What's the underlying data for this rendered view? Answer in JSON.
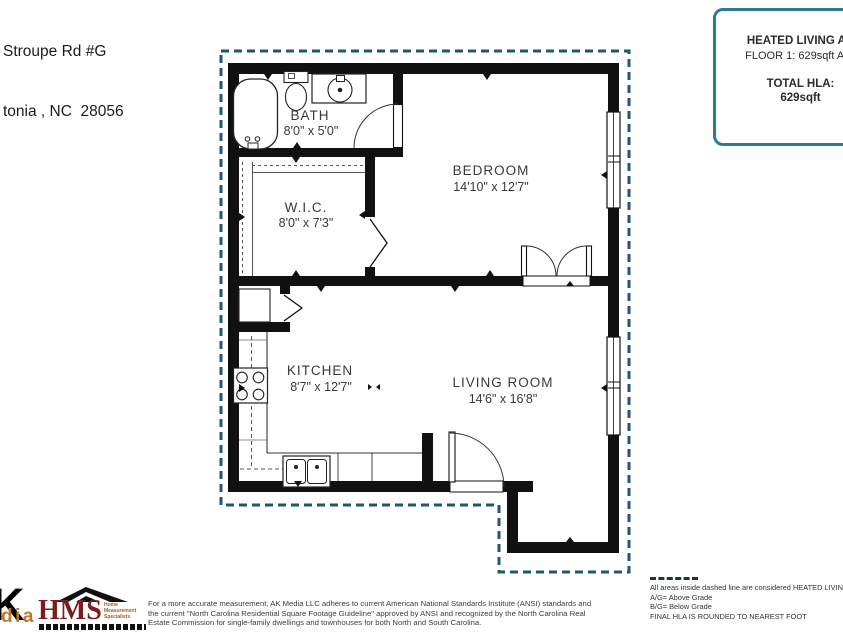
{
  "address": {
    "line1": "Stroupe Rd #G",
    "line2": "tonia , NC  28056"
  },
  "hla_box": {
    "title": "HEATED LIVING AR",
    "floor_line": "FLOOR 1: 629sqft  A/G",
    "total_label": "TOTAL HLA:",
    "total_value": "629sqft",
    "border_color": "#2a7b93"
  },
  "plan": {
    "boundary_color": "#1e586e",
    "wall_color": "#111111",
    "rooms": [
      {
        "name": "BATH",
        "dims": "8'0\" x 5'0\""
      },
      {
        "name": "BEDROOM",
        "dims": "14'10\" x 12'7\""
      },
      {
        "name": "W.I.C.",
        "dims": "8'0\" x 7'3\""
      },
      {
        "name": "KITCHEN",
        "dims": "8'7\" x 12'7\""
      },
      {
        "name": "LIVING ROOM",
        "dims": "14'6\" x 16'8\""
      }
    ]
  },
  "branding": {
    "ak_letter": "K",
    "ak_sub": "dia",
    "hms": "HMS",
    "hms_lines": [
      "Home",
      "Measurement",
      "Specialists"
    ]
  },
  "footer": {
    "disclaimer_lines": [
      "For a more accurate measurement, AK Media LLC adheres to current American National Standards Institute (ANSI) standards and",
      "the current \"North Carolina Residential Square Footage Guideline\" approved by ANSI and recognized by the North Carolina Real",
      "Estate Commission for single-family dwellings and townhouses for both North and South Carolina."
    ]
  },
  "legend": {
    "lines": [
      "All areas inside dashed line are considered HEATED LIVIN",
      "A/G= Above Grade",
      "B/G= Below Grade",
      "FINAL HLA IS ROUNDED TO NEAREST FOOT"
    ]
  }
}
